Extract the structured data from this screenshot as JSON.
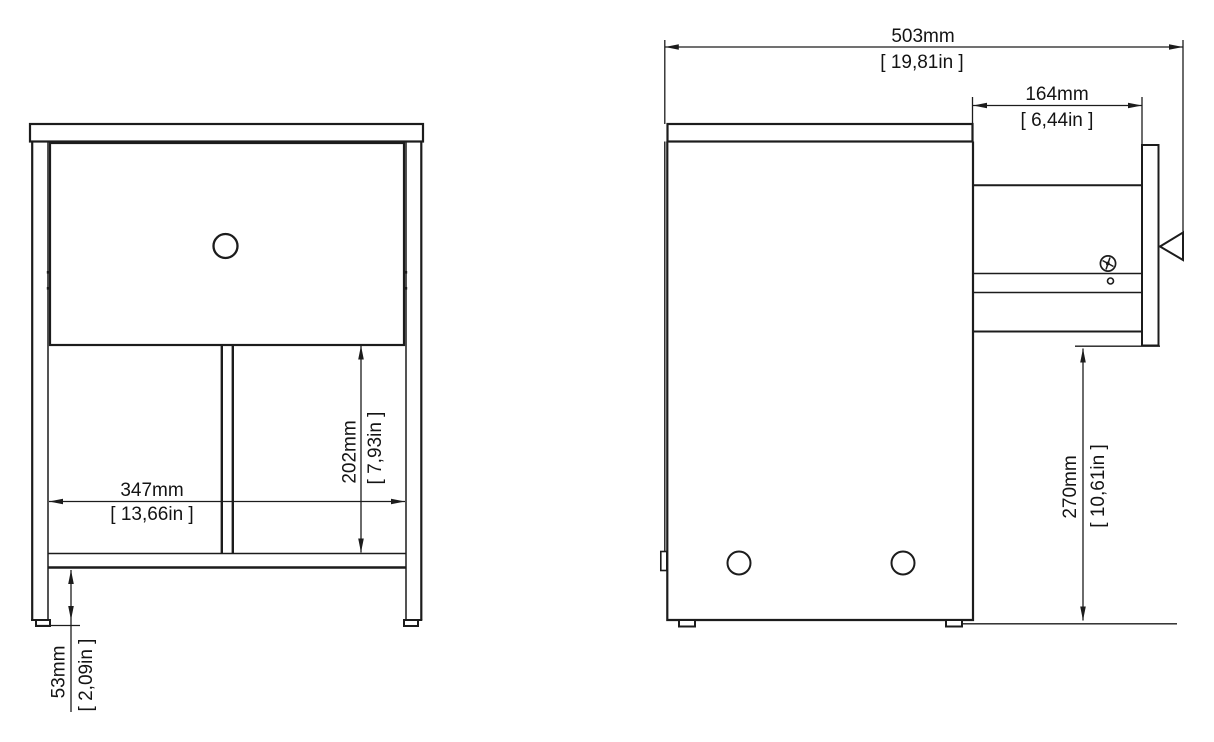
{
  "front_view": {
    "width": {
      "mm": "347mm",
      "inch": "[ 13,66in ]"
    },
    "drawer_to_shelf": {
      "mm": "202mm",
      "inch": "[ 7,93in ]"
    },
    "plinth_height": {
      "mm": "53mm",
      "inch": "[ 2,09in ]"
    }
  },
  "side_view": {
    "depth": {
      "mm": "503mm",
      "inch": "[ 19,81in ]"
    },
    "drawer_extension": {
      "mm": "164mm",
      "inch": "[ 6,44in ]"
    },
    "drawer_clearance": {
      "mm": "270mm",
      "inch": "[ 10,61in ]"
    }
  },
  "colors": {
    "line": "#1c1c1c",
    "background": "#ffffff"
  }
}
